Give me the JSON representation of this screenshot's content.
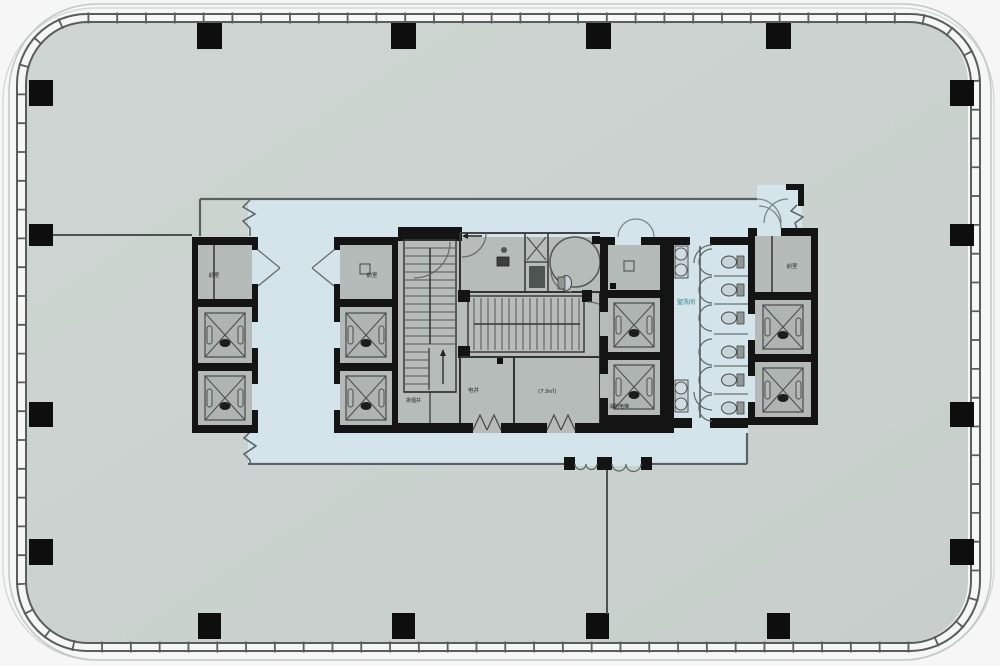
{
  "meta": {
    "type": "architectural floor plan",
    "description": "Office tower typical floor plan: rounded-rectangle curtain-wall perimeter, open floor plate with perimeter columns, central service core with four elevator banks, two stairs, restrooms and shafts; circulation corridor highlighted in light blue."
  },
  "palette": {
    "background": "#f5f6f5",
    "floor": "#cbd2cf",
    "circulation_blue": "#d3e4ea",
    "core_walls": "#131313",
    "room_fill": "#b5bbb8",
    "facade_line": "#575e5c",
    "teal_label": "#1e7f88"
  },
  "structure": {
    "perimeter_columns": {
      "top": 4,
      "bottom": 4,
      "left": 4,
      "right": 4
    },
    "elevator_banks": [
      {
        "name": "west bank",
        "lifts": 2
      },
      {
        "name": "mid-west bank",
        "lifts": 2
      },
      {
        "name": "mid-east bank",
        "lifts": 2
      },
      {
        "name": "east bank",
        "lifts": 2
      }
    ],
    "stairs": 2,
    "toilet_stalls": 6,
    "wash_basins": 4,
    "accessible_wc": 1
  },
  "labels": {
    "lobby_a": "前室",
    "lobby_b": "前室",
    "lobby_c": "前室",
    "smoke_shaft": "排烟井",
    "elec_shaft": "电井",
    "room_area": "(7.9㎡)",
    "fire_elevator": "消防电梯",
    "restroom": "盥洗间"
  }
}
